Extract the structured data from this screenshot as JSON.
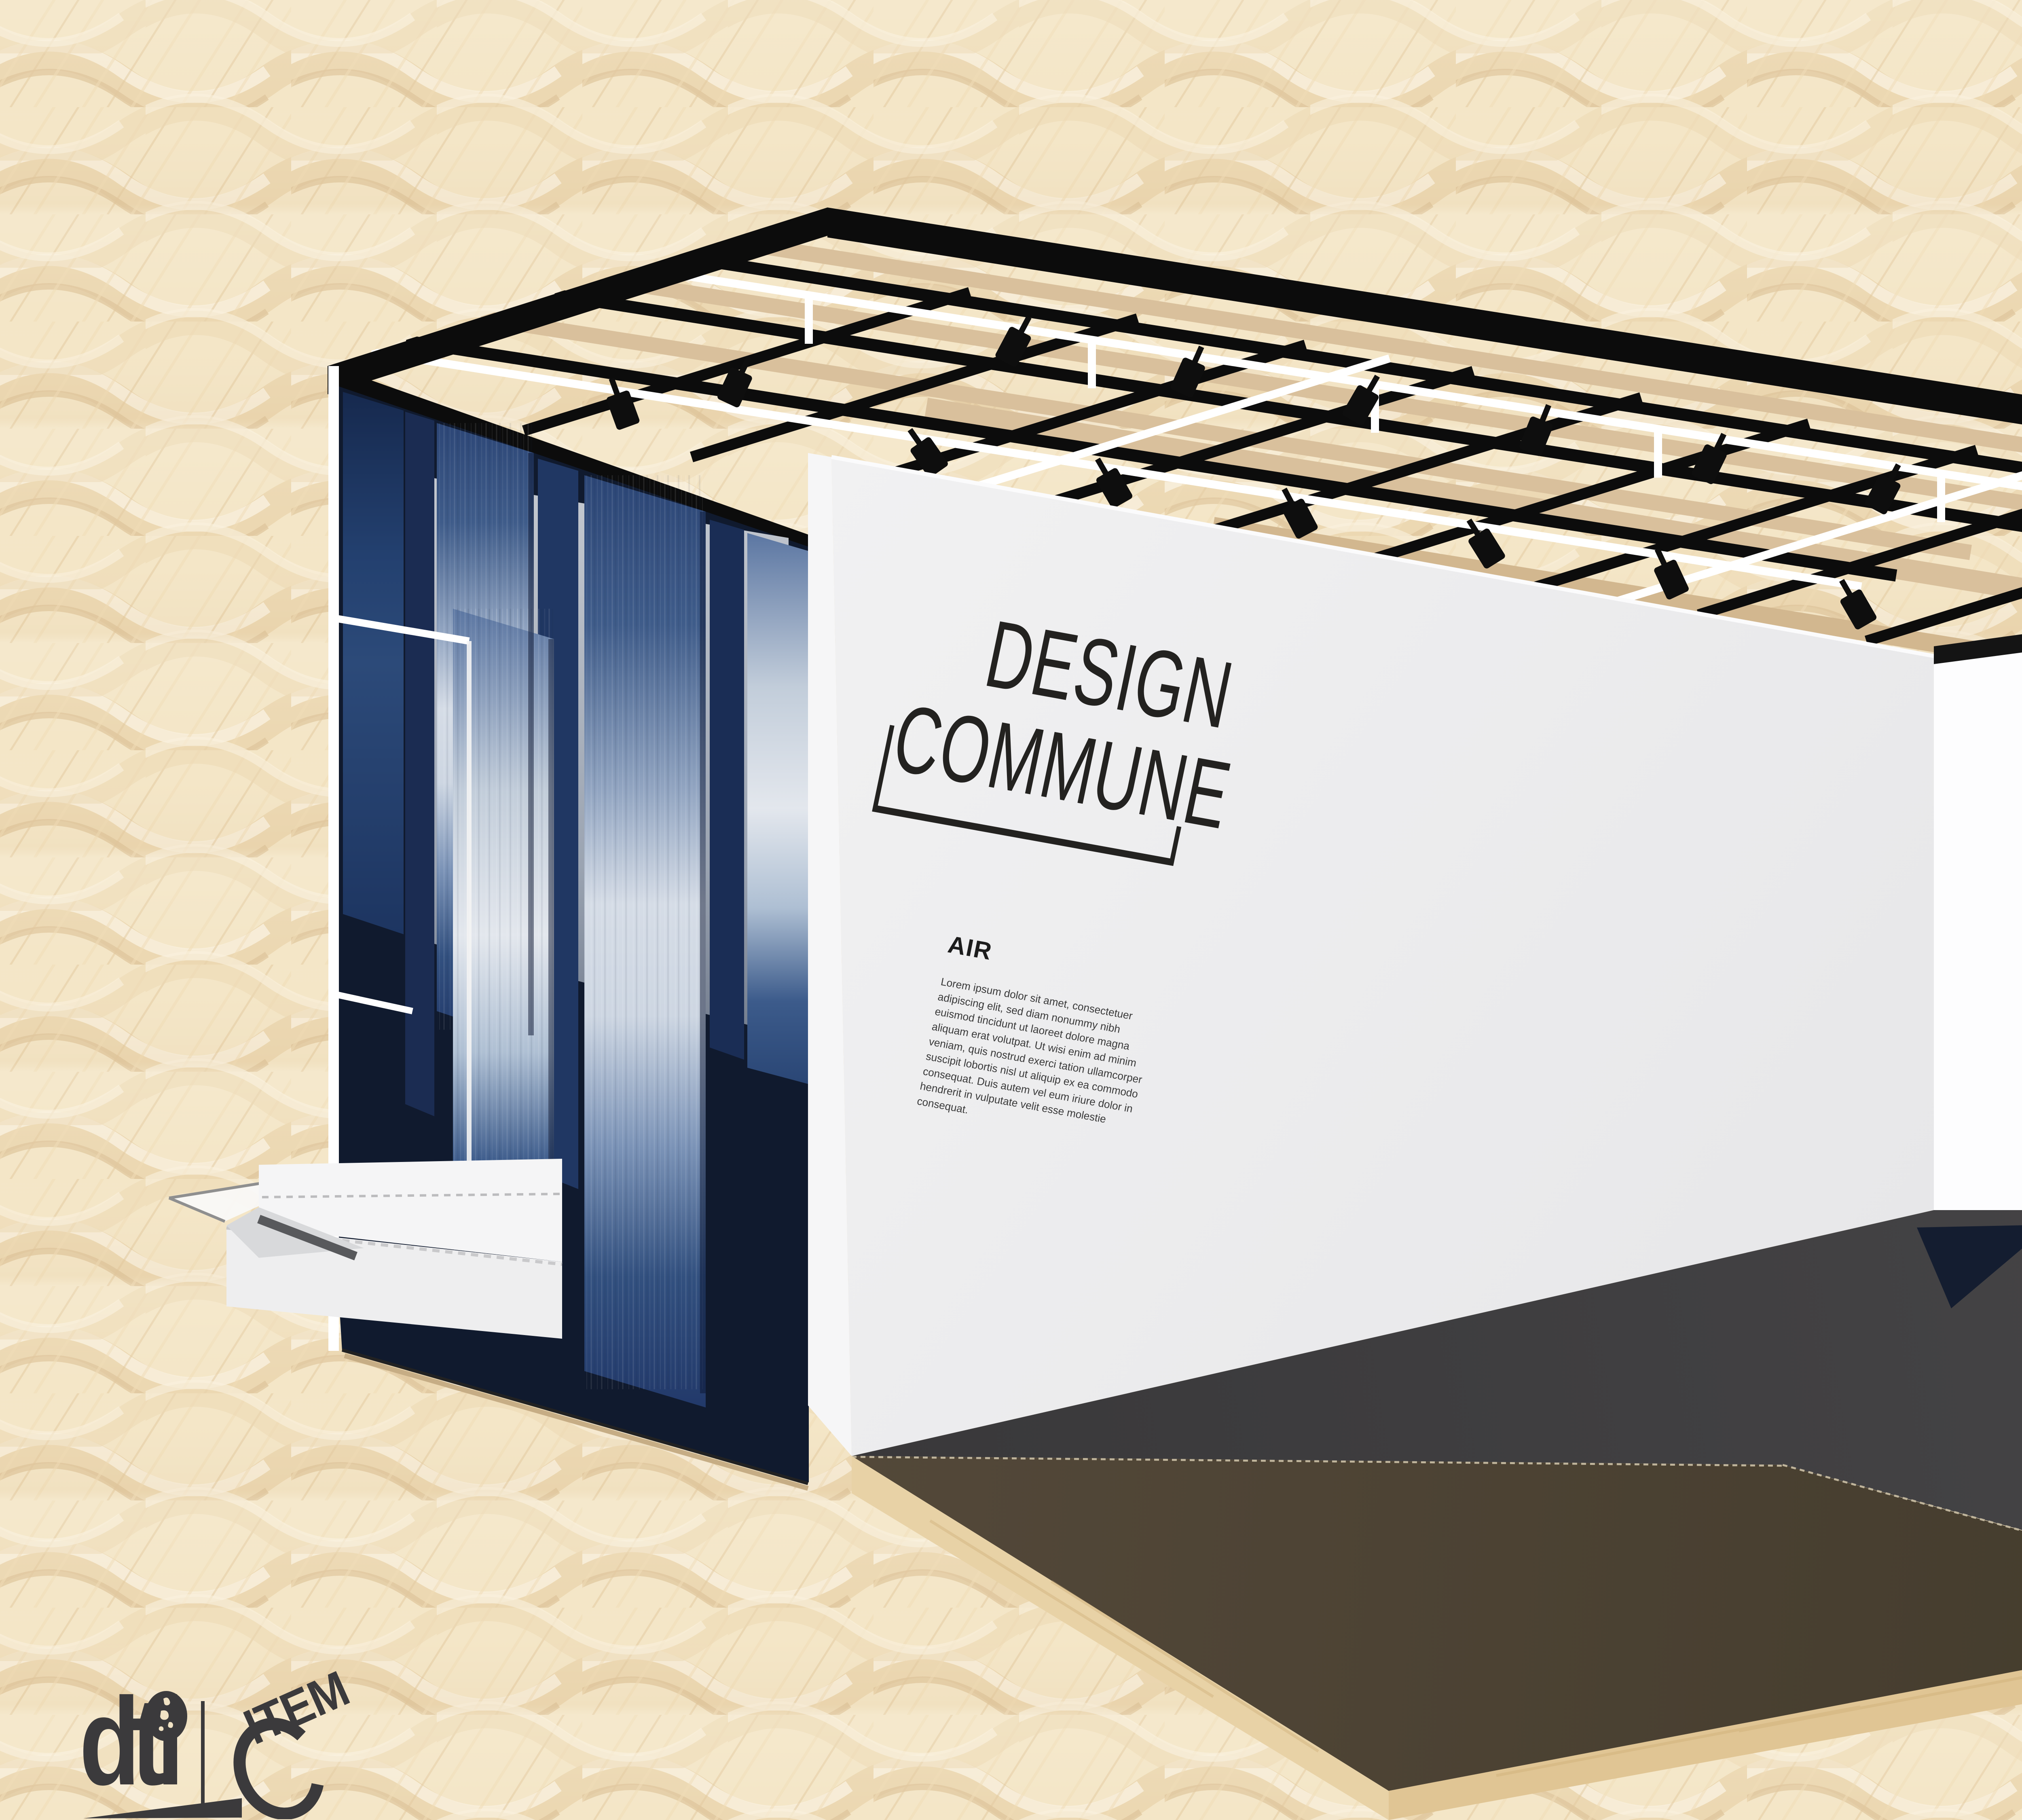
{
  "event_logo": {
    "line1": "MANILA",
    "line2": "FAME"
  },
  "booth": {
    "brand_line1": "DESIGN",
    "brand_line2": "COMMUNE",
    "section_heading": "AIR",
    "section_body": "Lorem ipsum dolor sit amet, consectetuer adipiscing elit, sed diam nonummy nibh euismod tincidunt ut laoreet dolore magna aliquam erat volutpat. Ut wisi enim ad minim veniam, quis nostrud exerci tation ullamcorper suscipit lobortis nisl ut aliquip ex ea commodo consequat. Duis autem vel eum iriure dolor in hendrerit in vulputate velit esse molestie consequat."
  },
  "organizers": {
    "dti_label": "dti",
    "citem_label": "ITEM"
  },
  "colors": {
    "background_weave": "#f3e5c6",
    "frame_black": "#0d0d0d",
    "frame_white": "#ffffff",
    "indigo_dark": "#1e3766",
    "indigo_light": "#d5dce6",
    "wall_white": "#ededef",
    "platform_top": "#4a4233",
    "plywood_edge": "#e4cb9c",
    "floor_charcoal": "#3e3d3f",
    "floor_navy": "#101a2e",
    "wood_strip": "#d9a967",
    "woven_panel": "#e9e4d4",
    "rust_door": "#6a4124",
    "logo_dark": "#39373a"
  }
}
